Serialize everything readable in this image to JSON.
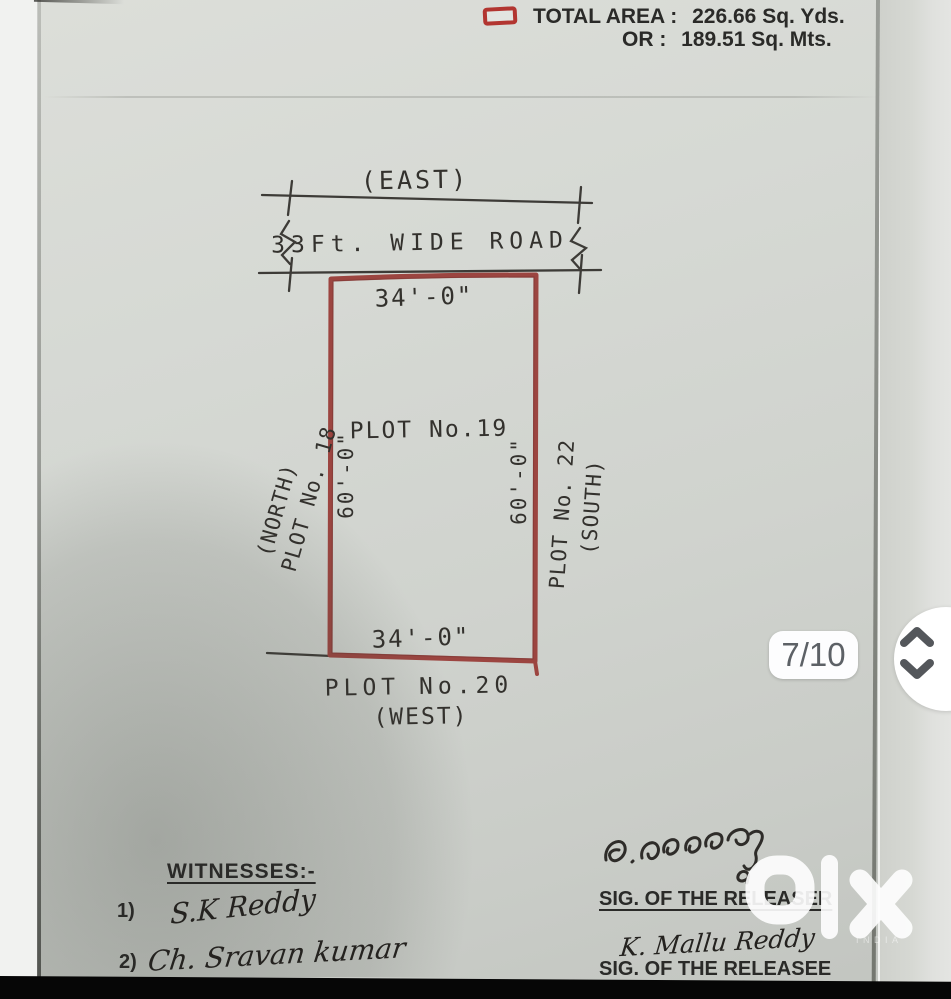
{
  "colors": {
    "plot_boundary": "#9c4540",
    "ink": "#33312d",
    "print_text": "#2a2a28",
    "badge_text": "#5d6166"
  },
  "header": {
    "total_area_label": "TOTAL AREA :",
    "total_area_value": "226.66 Sq. Yds.",
    "or_label": "OR :",
    "or_value": "189.51 Sq. Mts."
  },
  "diagram": {
    "east_label": "(EAST)",
    "road_label": "33Ft. WIDE ROAD",
    "top_dimension": "34'-0\"",
    "left_dimension": "60'-0\"",
    "right_dimension": "60'-0\"",
    "bottom_dimension": "34'-0\"",
    "plot_label": "PLOT No.19",
    "north_direction": "(NORTH)",
    "north_plot": "PLOT No. 18",
    "south_plot": "PLOT No. 22",
    "south_direction": "(SOUTH)",
    "west_plot": "PLOT No.20",
    "west_direction": "(WEST)"
  },
  "signatures": {
    "witnesses_title": "WITNESSES:-",
    "witness1_no": "1)",
    "witness1_name": "S.K Reddy",
    "witness2_no": "2)",
    "witness2_name": "Ch. Sravan kumar",
    "releaser_signature": "handwritten Telugu signature",
    "releaser_label": "SIG. OF THE RELEASER",
    "releasee_signature": "K. Mallu Reddy",
    "releasee_label": "SIG. OF THE RELEASEE"
  },
  "viewer": {
    "page_indicator": "7/10",
    "nav_up_icon": "chevron-up",
    "nav_down_icon": "chevron-down",
    "watermark_brand": "olx",
    "watermark_region": "INDIA"
  }
}
